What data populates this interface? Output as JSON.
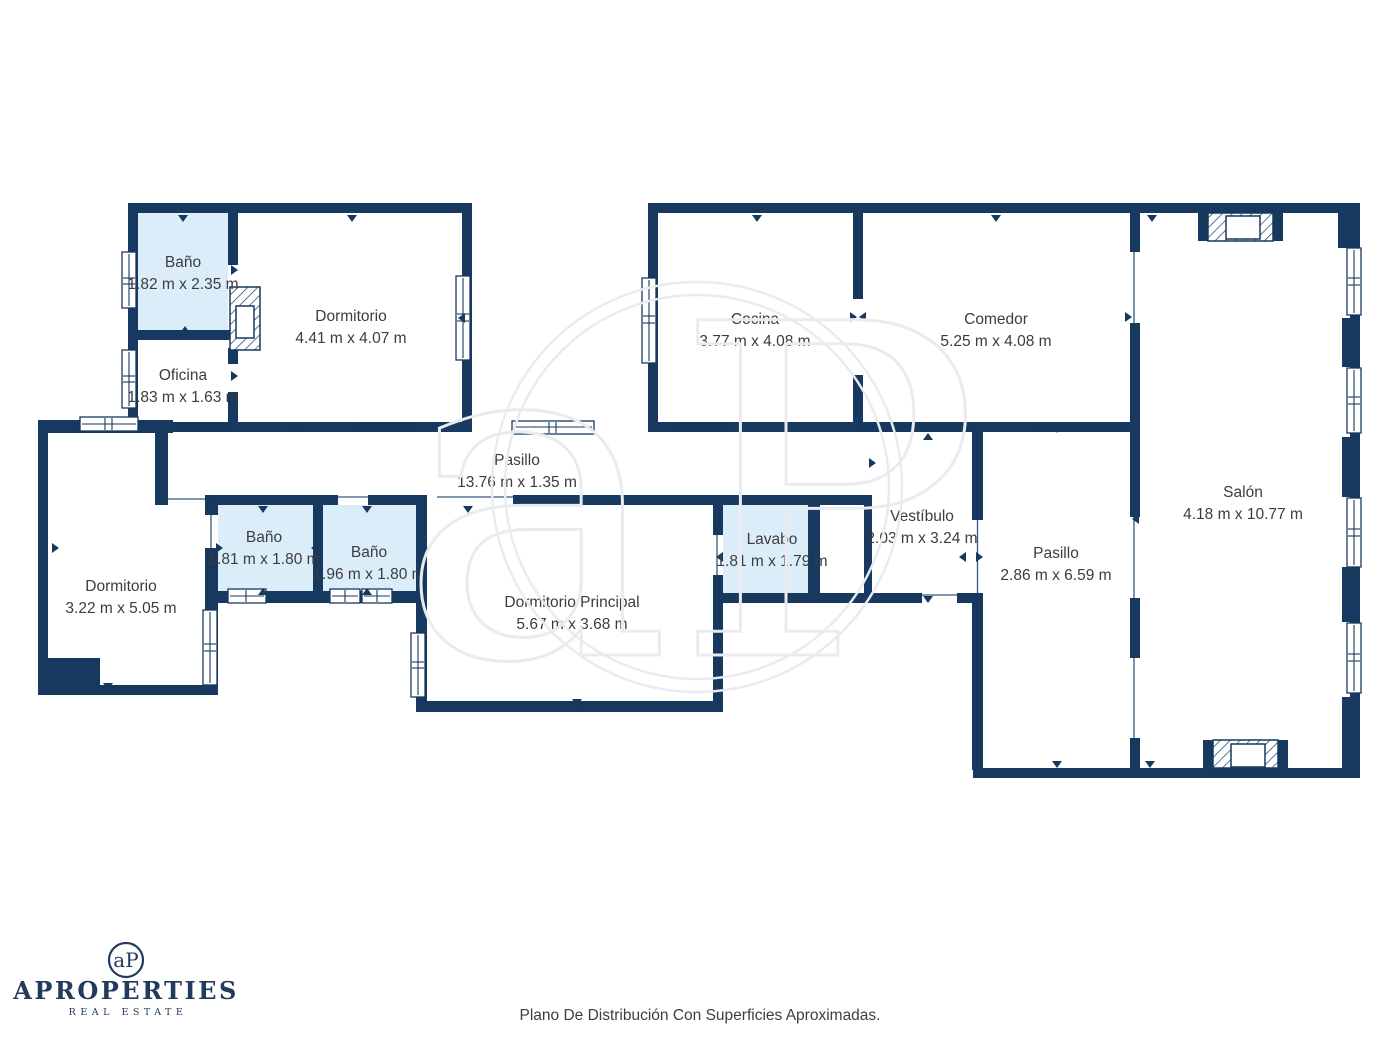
{
  "meta": {
    "caption": "Plano De Distribución Con Superficies Aproximadas."
  },
  "branding": {
    "monogram": "aP",
    "company": "APROPERTIES",
    "tagline": "REAL ESTATE"
  },
  "watermark": {
    "monogram": "aP"
  },
  "colors": {
    "wall": "#17395f",
    "bath_fill": "#dcedfa",
    "label_text": "#3c3c3e",
    "watermark": "#e9ecef",
    "brand_navy": "#223a5e"
  },
  "rooms": [
    {
      "id": "banyo-suite",
      "name": "Baño",
      "dims": "1.82 m x 2.35 m"
    },
    {
      "id": "dormitorio-1",
      "name": "Dormitorio",
      "dims": "4.41 m x 4.07 m"
    },
    {
      "id": "oficina",
      "name": "Oficina",
      "dims": "1.83 m x 1.63 m"
    },
    {
      "id": "cocina",
      "name": "Cocina",
      "dims": "3.77 m x 4.08 m"
    },
    {
      "id": "comedor",
      "name": "Comedor",
      "dims": "5.25 m x 4.08 m"
    },
    {
      "id": "salon",
      "name": "Salón",
      "dims": "4.18 m x 10.77 m"
    },
    {
      "id": "pasillo-horizontal",
      "name": "Pasillo",
      "dims": "13.76 m x 1.35 m"
    },
    {
      "id": "dormitorio-2",
      "name": "Dormitorio",
      "dims": "3.22 m x 5.05 m"
    },
    {
      "id": "banyo-2",
      "name": "Baño",
      "dims": "1.81 m x 1.80 m"
    },
    {
      "id": "banyo-3",
      "name": "Baño",
      "dims": "1.96 m x 1.80 m"
    },
    {
      "id": "dormitorio-principal",
      "name": "Dormitorio Principal",
      "dims": "5.67 m x 3.68 m"
    },
    {
      "id": "lavabo",
      "name": "Lavabo",
      "dims": "1.81 m x 1.79 m"
    },
    {
      "id": "vestibulo",
      "name": "Vestíbulo",
      "dims": "2.03 m x 3.24 m"
    },
    {
      "id": "pasillo-vertical",
      "name": "Pasillo",
      "dims": "2.86 m x 6.59 m"
    }
  ]
}
